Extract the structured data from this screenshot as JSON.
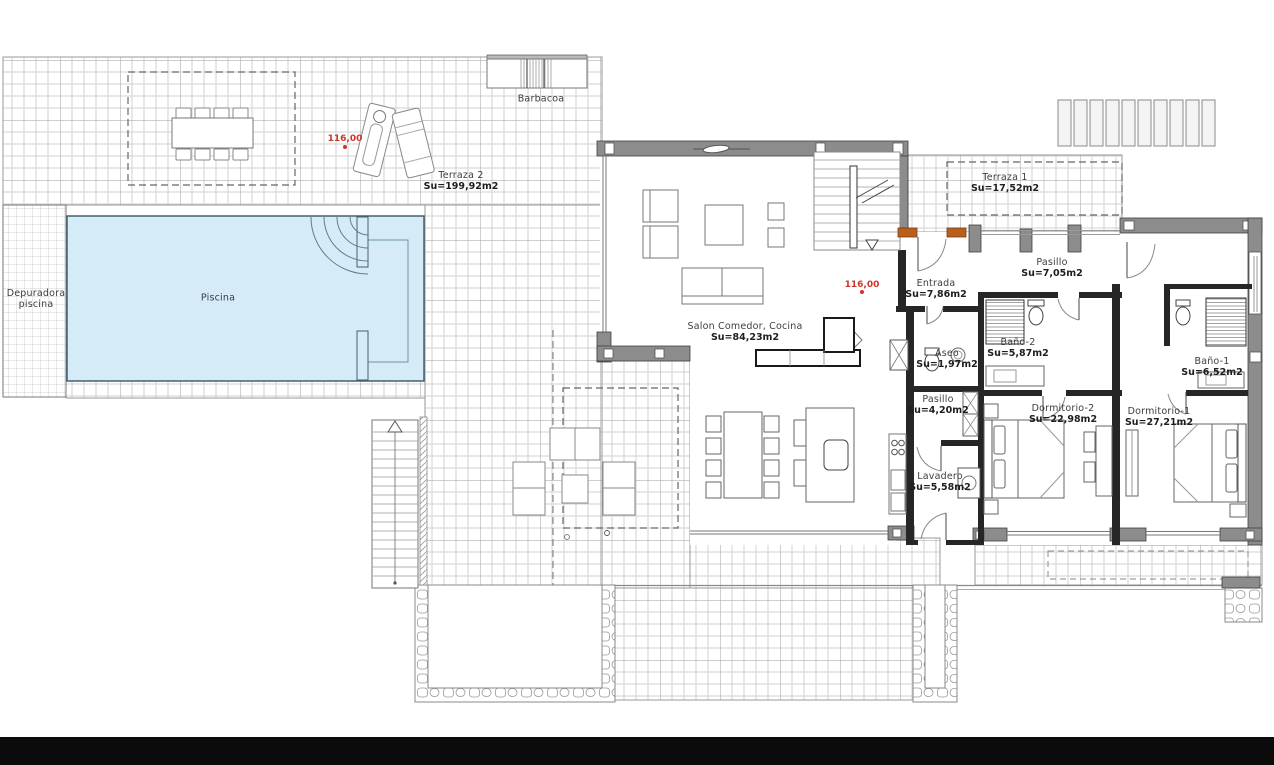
{
  "plan": {
    "rooms": [
      {
        "name": "Terraza 2",
        "area": "Su=199,92m2"
      },
      {
        "name": "Terraza 1",
        "area": "Su=17,52m2"
      },
      {
        "name": "Pasillo",
        "area": "Su=7,05m2"
      },
      {
        "name": "Entrada",
        "area": "Su=7,86m2"
      },
      {
        "name": "Salon Comedor, Cocina",
        "area": "Su=84,23m2"
      },
      {
        "name": "Aseo",
        "area": "Su=1,97m2"
      },
      {
        "name": "Baño-2",
        "area": "Su=5,87m2"
      },
      {
        "name": "Baño-1",
        "area": "Su=6,52m2"
      },
      {
        "name": "Pasillo",
        "area": "Su=4,20m2"
      },
      {
        "name": "Dormitorio-2",
        "area": "Su=22,98m2"
      },
      {
        "name": "Dormitorio-1",
        "area": "Su=27,21m2"
      },
      {
        "name": "Lavadero",
        "area": "Su=5,58m2"
      },
      {
        "name": "Piscina",
        "area": ""
      },
      {
        "name": "Depuradora",
        "area": "piscina"
      },
      {
        "name": "Barbacoa",
        "area": ""
      }
    ],
    "markers": [
      {
        "text": "116,00"
      },
      {
        "text": "116,00"
      }
    ],
    "colors": {
      "pool_fill": "#d5ebf7",
      "pool_edge": "#44606e",
      "wall_gray": "#8c8c8c",
      "partition": "#262626",
      "accent_orange": "#b95f1d",
      "marker_red": "#cf3427",
      "grid_minor": "#d2d2d2",
      "grid_major": "#b0b0b0",
      "label_text": "#3d3d3d"
    }
  }
}
